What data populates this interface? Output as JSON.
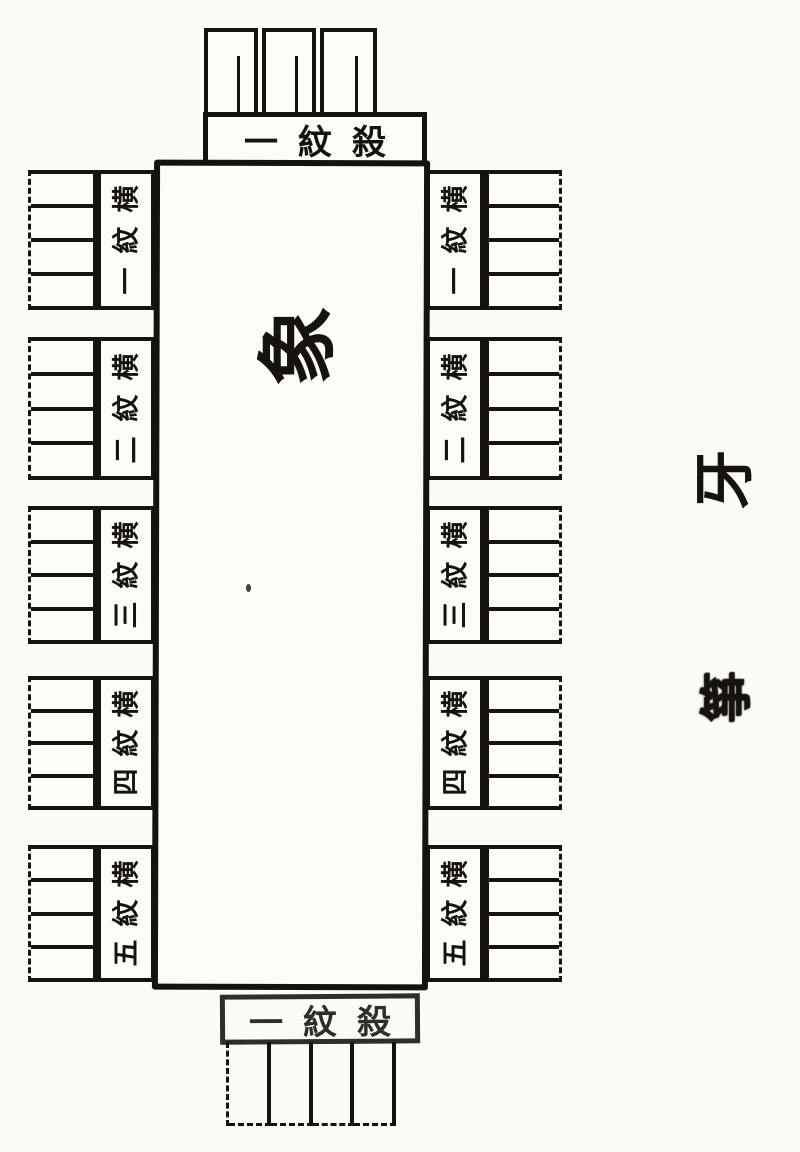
{
  "page": {
    "background_color": "#fbfaf6",
    "ink_color": "#16120d",
    "description": "Woodblock-print book diagram, page rotated 90 degrees: a long rectangle labelled with a large rotated character, comb-tooth groups on all four sides, five labelled sections per long side"
  },
  "center_character": "象",
  "end_labels": {
    "top": {
      "chars": [
        "一",
        "紋",
        "殺"
      ]
    },
    "bottom": {
      "chars": [
        "一",
        "紋",
        "殺"
      ]
    }
  },
  "side_labels": {
    "left": [
      {
        "chars": [
          "横",
          "紋",
          "一"
        ]
      },
      {
        "chars": [
          "横",
          "紋",
          "二"
        ]
      },
      {
        "chars": [
          "横",
          "紋",
          "三"
        ]
      },
      {
        "chars": [
          "横",
          "紋",
          "四"
        ]
      },
      {
        "chars": [
          "横",
          "紋",
          "五"
        ]
      }
    ],
    "right": [
      {
        "chars": [
          "横",
          "紋",
          "一"
        ]
      },
      {
        "chars": [
          "横",
          "紋",
          "二"
        ]
      },
      {
        "chars": [
          "横",
          "紋",
          "三"
        ]
      },
      {
        "chars": [
          "横",
          "紋",
          "四"
        ]
      },
      {
        "chars": [
          "横",
          "紋",
          "五"
        ]
      }
    ]
  },
  "margin_characters": {
    "upper": "牙",
    "lower": "箏"
  },
  "structure": {
    "top_teeth_cells": 3,
    "bottom_teeth_cells": 4,
    "side_groups_per_side": 5,
    "teeth_rows_per_side_group": 4
  }
}
